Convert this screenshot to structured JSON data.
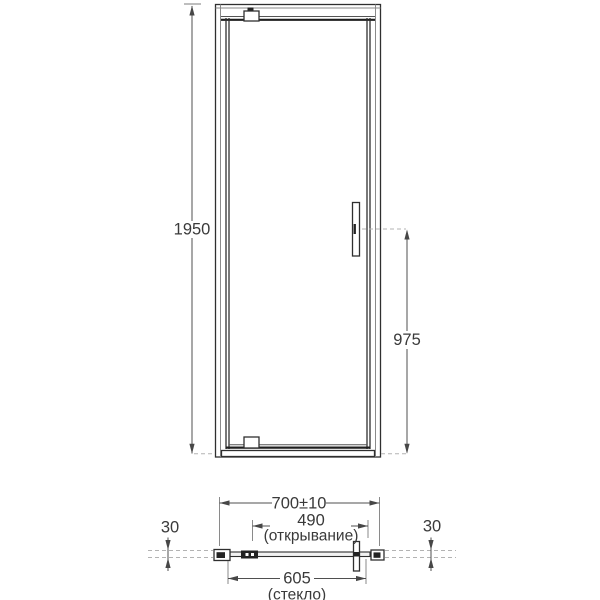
{
  "drawing": {
    "front": {
      "height": "1950",
      "handle_height": "975"
    },
    "plan": {
      "total_width": "700±10",
      "opening": "490",
      "opening_note": "(открывание)",
      "glass_width": "605",
      "glass_note": "(стекло)",
      "left_offset": "30",
      "right_offset": "30"
    },
    "colors": {
      "line": "#2f2f2f",
      "dimension": "#4f4f4f",
      "dashed": "#b3b3b3",
      "text": "#3a3a3a",
      "background": "#ffffff"
    }
  }
}
